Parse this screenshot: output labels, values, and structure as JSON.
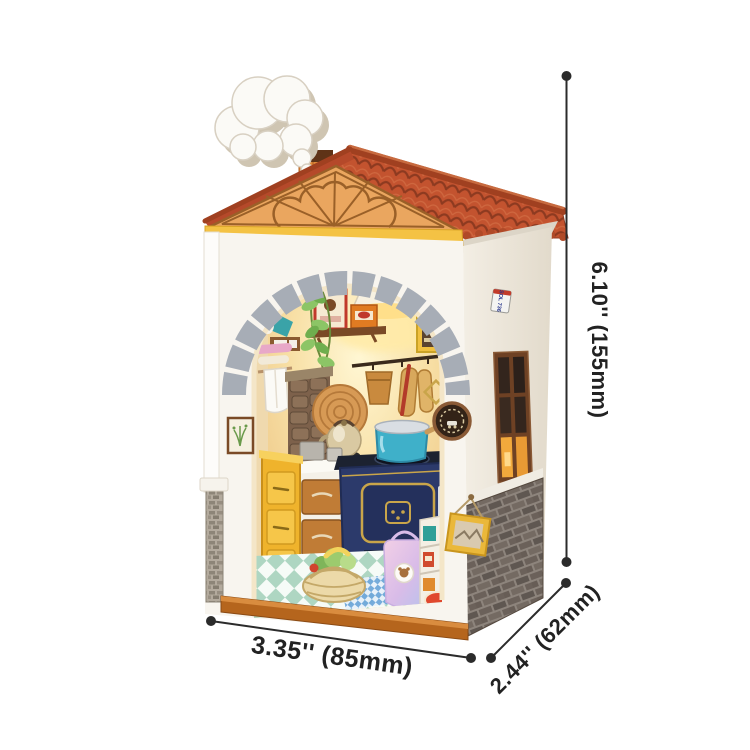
{
  "dimensions": {
    "height_label": "6.10'' (155mm)",
    "width_label": "3.35'' (85mm)",
    "depth_label": "2.44'' (62mm)"
  },
  "miniature": {
    "license_plate": "SOL 736"
  },
  "colors": {
    "roof_tile": "#c3532f",
    "roof_tile_dark": "#8d3a20",
    "gable_wood": "#eaa65f",
    "fascia_yellow": "#f4c244",
    "front_wall": "#f8f5ef",
    "side_wall": "#ece5d9",
    "arch_stone": "#a7adb6",
    "base_stone_mortar": "#8d847c",
    "wood_floor": "#b5651d",
    "cabinet_yellow": "#efb32c",
    "stove_navy": "#2c3a6b",
    "pot_teal": "#3fb0c9",
    "bag_lilac": "#d9bce8",
    "smoke_white": "#fbfaf6",
    "annotation_ink": "#2b2b2b"
  }
}
